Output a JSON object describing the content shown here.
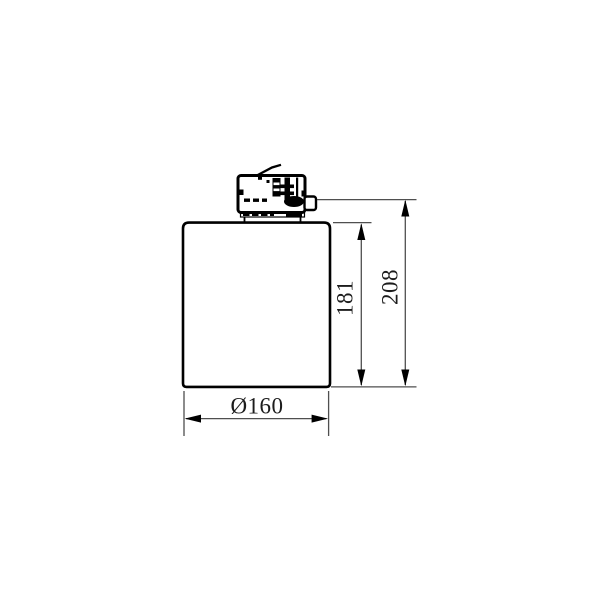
{
  "drawing": {
    "kind": "technical dimension drawing",
    "subject": "cylindrical track-mounted luminaire with track adapter, side view",
    "dimensions": {
      "body_height": "181",
      "total_height": "208",
      "diameter": "Ø160"
    },
    "colors": {
      "background": "#ffffff",
      "outline": "#000000",
      "dimension_line": "#4f4f4f",
      "label_text": "#1c1c1c"
    }
  }
}
